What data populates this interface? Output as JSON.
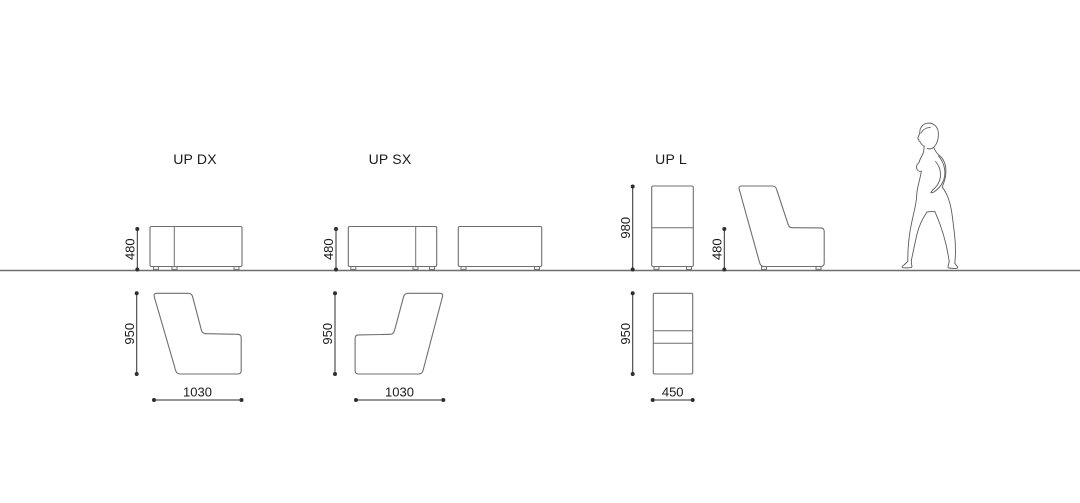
{
  "diagram": {
    "title": "",
    "products": [
      {
        "name": "UP DX",
        "seat_height": "480",
        "profile_height": "950",
        "width": "1030"
      },
      {
        "name": "UP SX",
        "seat_height": "480",
        "profile_height": "950",
        "width": "1030"
      },
      {
        "name": "UP L",
        "overall_height": "980",
        "seat_height": "480",
        "profile_height": "950",
        "width": "450"
      }
    ],
    "colors": {
      "line": "#6f6f6f",
      "dim": "#2e2e2e",
      "text": "#1a1a1a",
      "background": "#ffffff"
    },
    "icons": {
      "human_figure": "standing-woman-scale-figure"
    }
  }
}
